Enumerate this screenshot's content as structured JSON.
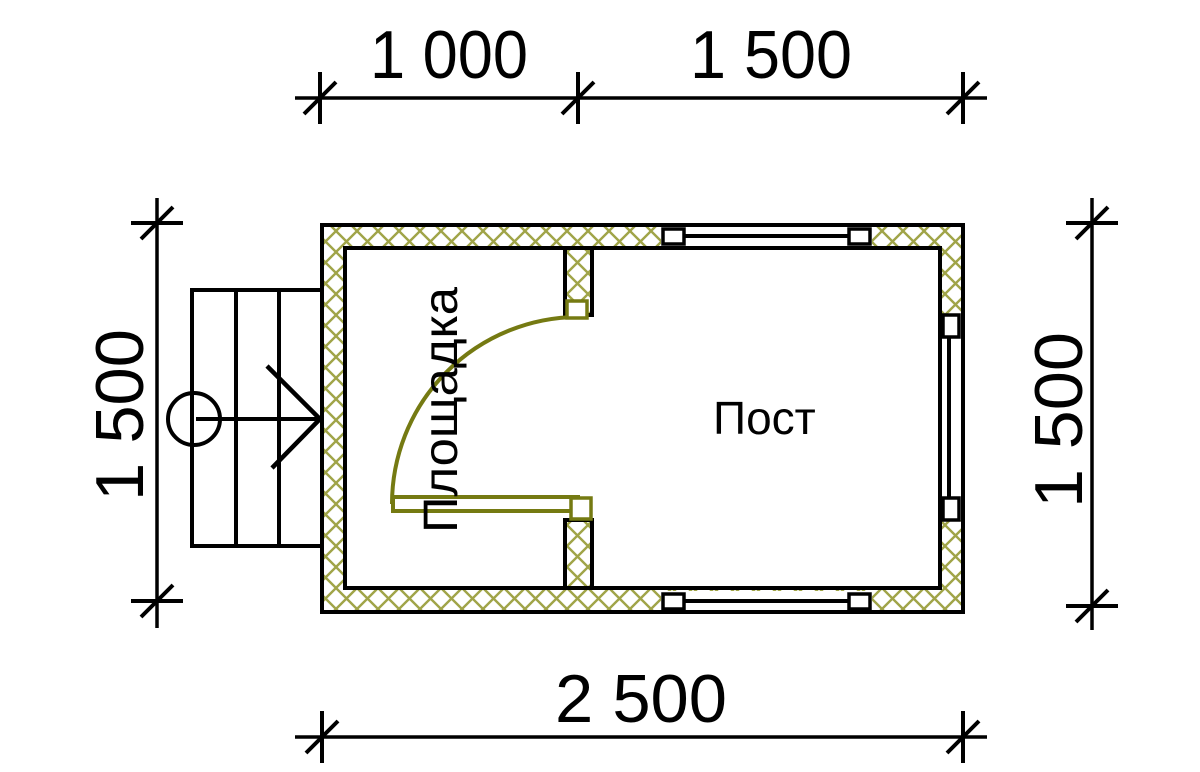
{
  "drawing": {
    "title": "floor-plan-guard-post",
    "dimensions": {
      "top_left": "1 000",
      "top_right": "1 500",
      "left": "1 500",
      "right": "1 500",
      "bottom": "2 500"
    },
    "rooms": {
      "platform": "Площадка",
      "post": "Пост"
    }
  },
  "watermark": {
    "text": "VANDA"
  },
  "colors": {
    "line": "#000000",
    "hatch": "#a0a448",
    "door": "#757a12",
    "logo_pink": "#f8cdd5",
    "logo_pink_dark": "#f1a9b5",
    "logo_blue": "#d4e4f2",
    "logo_blue_light": "#e3eef8",
    "logo_blue_dark": "#bed3e6"
  }
}
